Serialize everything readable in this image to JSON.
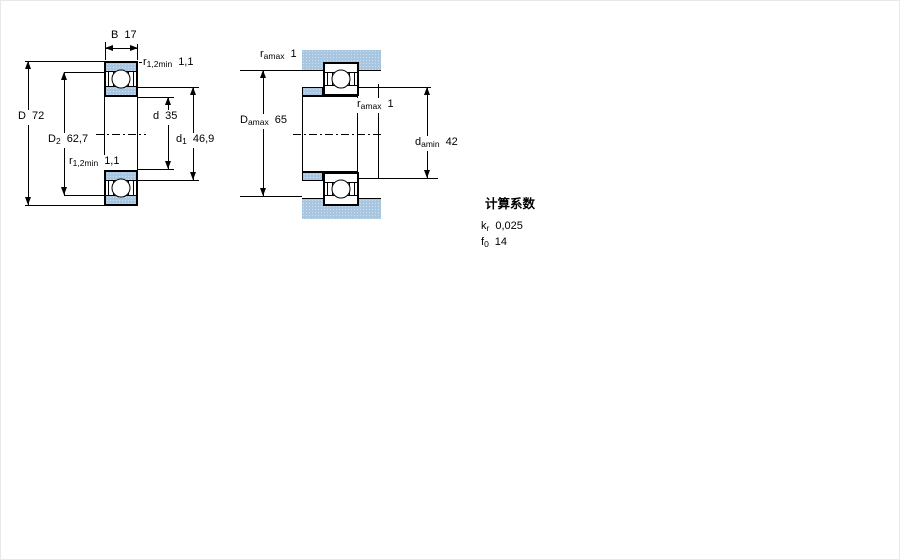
{
  "drawing": {
    "left_view": {
      "b": {
        "base": "B",
        "sub": "",
        "value": "17"
      },
      "r_top": {
        "base": "r",
        "sub": "1,2min",
        "value": "1,1"
      },
      "D": {
        "base": "D",
        "sub": "",
        "value": "72"
      },
      "D2": {
        "base": "D",
        "sub": "2",
        "value": "62,7"
      },
      "d": {
        "base": "d",
        "sub": "",
        "value": "35"
      },
      "d1": {
        "base": "d",
        "sub": "1",
        "value": "46,9"
      },
      "r_bottom": {
        "base": "r",
        "sub": "1,2min",
        "value": "1,1"
      }
    },
    "right_view": {
      "r_top": {
        "base": "r",
        "sub": "amax",
        "value": "1"
      },
      "Damax": {
        "base": "D",
        "sub": "amax",
        "value": "65"
      },
      "r_mid": {
        "base": "r",
        "sub": "amax",
        "value": "1"
      },
      "damin": {
        "base": "d",
        "sub": "amin",
        "value": "42"
      }
    },
    "calculation_factors": {
      "title": "计算系数",
      "kr": {
        "base": "k",
        "sub": "r",
        "value": "0,025"
      },
      "f0": {
        "base": "f",
        "sub": "0",
        "value": "14"
      }
    },
    "colors": {
      "fill": "#a9c6e0",
      "line": "#000000"
    }
  }
}
